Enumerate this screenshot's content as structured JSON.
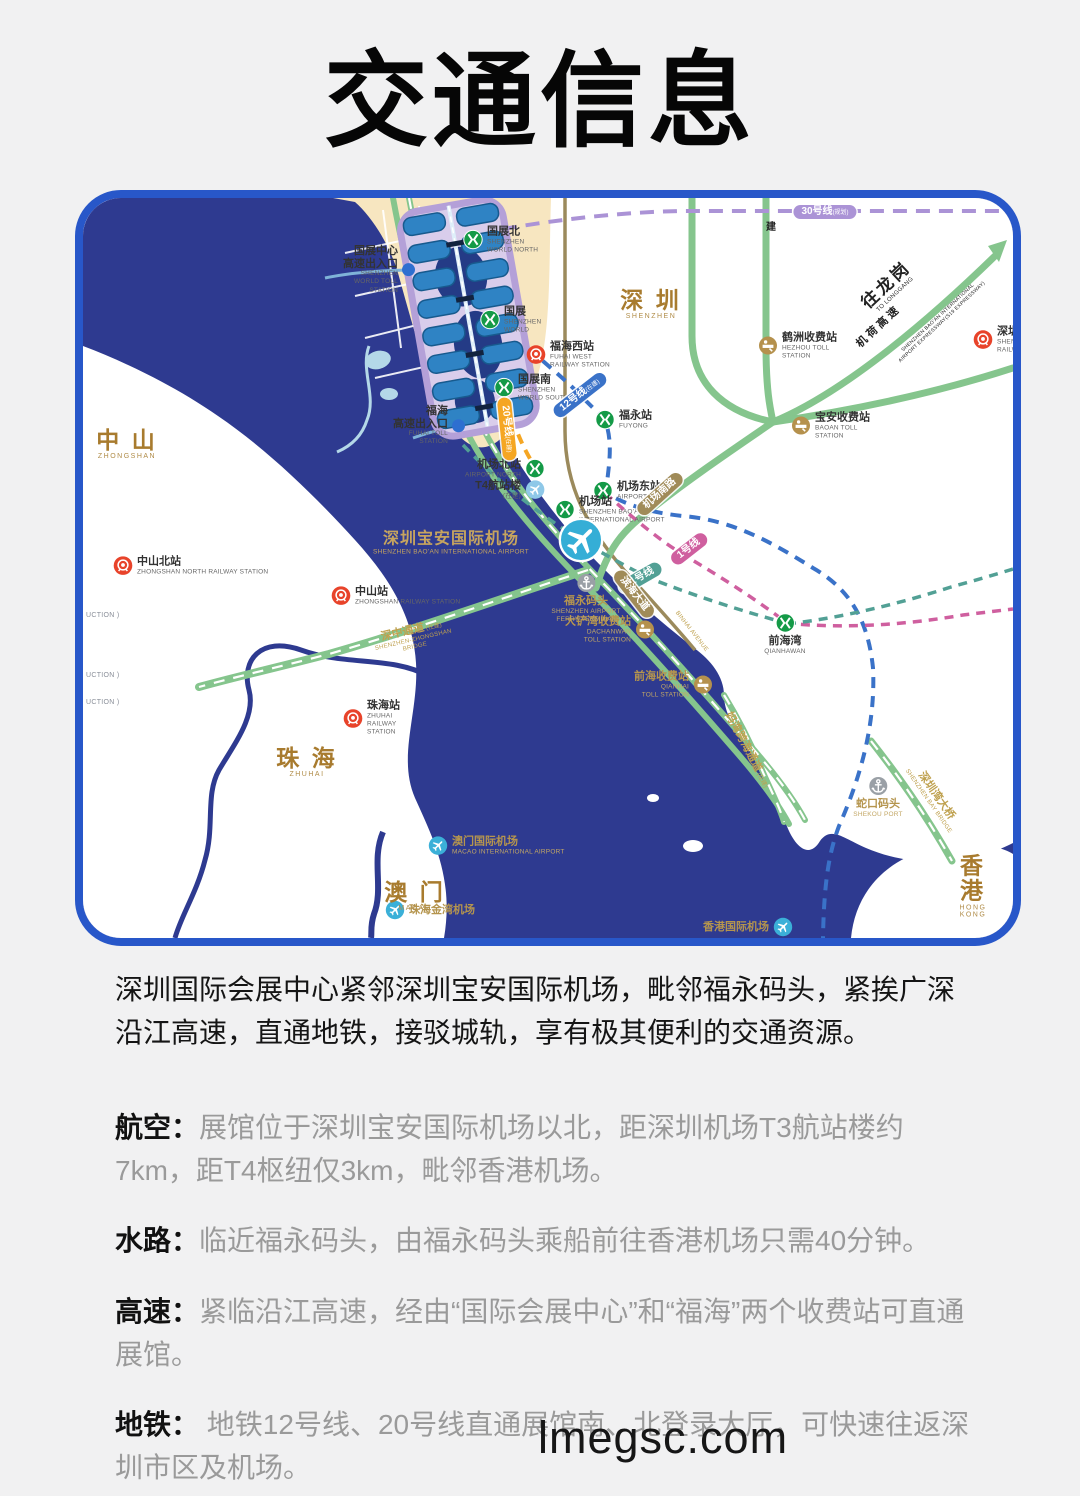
{
  "page": {
    "title": "交通信息",
    "watermark": "lmegsc.com",
    "background": "#f1f1f2"
  },
  "colors": {
    "map_border": "#2857c9",
    "sea": "#2e3a90",
    "land": "#ffffff",
    "district_land": "#f7e6c0",
    "road_green": "#85c58d",
    "road_khaki": "#9b8a5c",
    "line12_blue": "#3a72c8",
    "line20_orange": "#f5a623",
    "line30_purple": "#ab93d6",
    "line1_pink": "#cf5f9f",
    "line11_teal": "#52a095",
    "metro_green": "#149a47",
    "rail_red": "#e8432a",
    "toll_brown": "#b5914d",
    "plane_cyan": "#3bb0d8",
    "gold_text": "#bfa14f",
    "city_brown": "#a87b2e"
  },
  "map": {
    "regions": [
      {
        "name": "region-zhongshan",
        "zh": "中 山",
        "en": "ZHONGSHAN",
        "x": 44,
        "y": 246
      },
      {
        "name": "region-shenzhen",
        "zh": "深 圳",
        "en": "SHENZHEN",
        "x": 568,
        "y": 106
      },
      {
        "name": "region-zhuhai",
        "zh": "珠 海",
        "en": "ZHUHAI",
        "x": 224,
        "y": 564
      },
      {
        "name": "region-macao",
        "zh": "澳 门",
        "en": "MACAO",
        "x": 332,
        "y": 698
      },
      {
        "name": "region-hongkong",
        "zh": "香 港",
        "en": "HONG KONG",
        "x": 890,
        "y": 688
      }
    ],
    "sea_labels": [
      {
        "name": "label-baoan-airport",
        "zh": "深圳宝安国际机场",
        "en": "SHENZHEN BAO'AN INTERNATIONAL AIRPORT",
        "x": 368,
        "y": 342
      }
    ],
    "stations": [
      {
        "name": "station-shenzhen-world-north",
        "icon": "metro",
        "x": 390,
        "y": 42,
        "zh": "国展北",
        "en": "SHENZHEN\nWORLD NORTH",
        "align": "right"
      },
      {
        "name": "station-shenzhen-world",
        "icon": "metro",
        "x": 407,
        "y": 122,
        "zh": "国展",
        "en": "SHENZHEN\nWORLD",
        "align": "right"
      },
      {
        "name": "station-shenzhen-world-south",
        "icon": "metro",
        "x": 421,
        "y": 190,
        "zh": "国展南",
        "en": "SHENZHEN\nWORLD SOUTH",
        "align": "right"
      },
      {
        "name": "station-fuyong",
        "icon": "metro",
        "x": 522,
        "y": 222,
        "zh": "福永站",
        "en": "FUYONG",
        "align": "right"
      },
      {
        "name": "station-airport-north",
        "icon": "metro",
        "x": 452,
        "y": 271,
        "zh": "机场北站",
        "en": "AIRPORT NORTH",
        "align": "left"
      },
      {
        "name": "station-t4-terminal",
        "icon": "planeS",
        "c": "#8fc8e8",
        "x": 452,
        "y": 292,
        "zh": "T4航站楼",
        "en": "(在建)",
        "align": "left"
      },
      {
        "name": "station-airport-east",
        "icon": "metro",
        "x": 520,
        "y": 293,
        "zh": "机场东站",
        "en": "AIRPORT EAST",
        "align": "right"
      },
      {
        "name": "station-airport",
        "icon": "metro",
        "x": 482,
        "y": 312,
        "zh": "机场站",
        "en": "SHENZHEN BAO'AN\nINTERNATIONAL AIRPORT",
        "align": "right"
      },
      {
        "name": "airport-plane-marker",
        "icon": "planeB",
        "x": 485,
        "y": 342,
        "zh": "",
        "en": "",
        "align": "right"
      },
      {
        "name": "station-qianhaiwan",
        "icon": "metro",
        "x": 702,
        "y": 425,
        "zh": "前海湾",
        "en": "QIANHAWAN",
        "align": "below"
      },
      {
        "name": "station-fuhai-west",
        "icon": "rail",
        "x": 453,
        "y": 157,
        "zh": "福海西站",
        "en": "FUHAI WEST\nRAILWAY STATION",
        "align": "right"
      },
      {
        "name": "station-shenzhen-north",
        "icon": "rail",
        "x": 900,
        "y": 142,
        "zh": "深圳北站",
        "en": "SHENZHEN NORTH\nRAILWAY STATION",
        "align": "right"
      },
      {
        "name": "station-zhongshan-north",
        "icon": "rail",
        "x": 40,
        "y": 368,
        "zh": "中山北站",
        "en": "ZHONGSHAN NORTH RAILWAY STATION",
        "align": "right"
      },
      {
        "name": "station-zhongshan",
        "icon": "rail",
        "x": 258,
        "y": 398,
        "zh": "中山站",
        "en": "ZHONGSHAN RAILWAY STATION",
        "align": "right"
      },
      {
        "name": "station-zhuhai",
        "icon": "rail",
        "x": 270,
        "y": 520,
        "zh": "珠海站",
        "en": "ZHUHAI\nRAILWAY\nSTATION",
        "align": "right"
      },
      {
        "name": "toll-hezhou",
        "icon": "toll",
        "x": 685,
        "y": 148,
        "zh": "鹤洲收费站",
        "en": "HEZHOU TOLL\nSTATION",
        "align": "right"
      },
      {
        "name": "toll-baoan",
        "icon": "toll",
        "x": 718,
        "y": 228,
        "zh": "宝安收费站",
        "en": "BAOAN TOLL\nSTATION",
        "align": "right"
      },
      {
        "name": "toll-dachanwan",
        "icon": "toll",
        "x": 562,
        "y": 432,
        "zh": "大铲湾收费站",
        "en": "DACHANWAN\nTOLL STATION",
        "align": "left",
        "gold": true
      },
      {
        "name": "toll-qianhai",
        "icon": "toll",
        "x": 620,
        "y": 487,
        "zh": "前海收费站",
        "en": "QIANHAI\nTOLL STATION",
        "align": "left",
        "gold": true
      },
      {
        "name": "port-fuyong-ferry",
        "icon": "anchor",
        "x": 503,
        "y": 385,
        "zh": "福永码头",
        "en": "SHENZHEN AIRPORT\nFERRY TERMINAL",
        "align": "below",
        "gold": true
      },
      {
        "name": "port-shekou",
        "icon": "anchor",
        "x": 795,
        "y": 588,
        "zh": "蛇口码头",
        "en": "SHEKOU PORT",
        "align": "below",
        "gold": true
      },
      {
        "name": "airport-macao",
        "icon": "planeS",
        "x": 355,
        "y": 648,
        "zh": "澳门国际机场",
        "en": "MACAO INTERNATIONAL AIRPORT",
        "align": "right",
        "gold": true
      },
      {
        "name": "airport-zhuhai-jinwan",
        "icon": "planeS",
        "x": 312,
        "y": 712,
        "zh": "珠海金湾机场",
        "en": "",
        "align": "right",
        "gold": true
      },
      {
        "name": "airport-hongkong",
        "icon": "planeS",
        "x": 700,
        "y": 729,
        "zh": "香港国际机场",
        "en": "",
        "align": "left",
        "gold": true
      },
      {
        "name": "entrance-shenzhen-world-toll",
        "icon": "dot",
        "x": 322,
        "y": 72,
        "zh": "国展中心\n高速出入口",
        "en": "SHENZHEN\nWORLD TOLL\nSTATION",
        "align": "left"
      },
      {
        "name": "entrance-fuhai-toll",
        "icon": "dot",
        "x": 372,
        "y": 228,
        "zh": "福海\n高速出入口",
        "en": "FUHAI TOLL\nSTATION",
        "align": "left"
      }
    ],
    "line_pills": [
      {
        "name": "pill-line-30",
        "label": "30号线",
        "sfx": "(规划)",
        "x": 742,
        "y": 14,
        "rot": 0,
        "bg": "#ab93d6"
      },
      {
        "name": "pill-line-12",
        "label": "12号线",
        "sfx": "(在建)",
        "x": 497,
        "y": 197,
        "rot": -38,
        "bg": "#3a72c8"
      },
      {
        "name": "pill-line-20",
        "label": "20号线",
        "sfx": "(在建)",
        "x": 424,
        "y": 231,
        "rot": 84,
        "bg": "#f5a623"
      },
      {
        "name": "pill-line-1",
        "label": "1号线",
        "sfx": "",
        "x": 606,
        "y": 351,
        "rot": -38,
        "bg": "#cf5f9f"
      },
      {
        "name": "pill-line-11",
        "label": "11号线",
        "sfx": "",
        "x": 557,
        "y": 380,
        "rot": -30,
        "bg": "#52a095"
      },
      {
        "name": "pill-binhai-avenue",
        "label": "滨海大道",
        "sfx": "",
        "x": 551,
        "y": 396,
        "rot": 52,
        "bg": "#a08b58"
      },
      {
        "name": "pill-airport-south-road",
        "label": "机场南路",
        "sfx": "",
        "x": 577,
        "y": 296,
        "rot": -42,
        "bg": "#a08b58"
      }
    ],
    "road_labels": [
      {
        "name": "label-shenzhong-bridge",
        "zh": "深中通道",
        "sfx": "(在建)",
        "en": "SHENZHEN-ZHONGSHAN\nBRIDGE",
        "x": 330,
        "y": 440,
        "rot": -13,
        "cls": "gold"
      },
      {
        "name": "label-mawan-crossing",
        "zh": "妈湾跨海通道",
        "sfx": "(在建)",
        "en": "",
        "x": 664,
        "y": 552,
        "rot": 62,
        "cls": "gold"
      },
      {
        "name": "label-shenzhen-bay-bridge",
        "zh": "深圳湾大桥",
        "sfx": "",
        "en": "SHENZHEN BAY BRIDGE",
        "x": 850,
        "y": 600,
        "rot": 55,
        "cls": "gold"
      },
      {
        "name": "label-binhai-avenue-en",
        "zh": "",
        "sfx": "",
        "en": "BINHAI AVENUE",
        "x": 608,
        "y": 434,
        "rot": 52,
        "cls": "gold"
      },
      {
        "name": "label-jihe-expressway",
        "zh": "机 荷 高 速",
        "sfx": "",
        "en": "",
        "x": 795,
        "y": 130,
        "rot": -43,
        "cls": "dark"
      },
      {
        "name": "label-to-longgang",
        "zh": "往龙岗",
        "sfx": "",
        "en": "TO LONGGANG",
        "x": 806,
        "y": 90,
        "rot": -43,
        "cls": "dark lg"
      },
      {
        "name": "label-s19-expressway",
        "zh": "",
        "sfx": "",
        "en": "SHENZHEN BAO'AN INTERNATIONAL\nAIRPORT EXPRESSWAY(S19 EXPRESSWAY)",
        "x": 857,
        "y": 122,
        "rot": -43,
        "cls": "dark tiny"
      },
      {
        "name": "label-jian",
        "zh": "建",
        "sfx": "",
        "en": "",
        "x": 688,
        "y": 30,
        "rot": 0,
        "cls": "dark sm"
      },
      {
        "name": "label-cut-1",
        "zh": "",
        "sfx": "",
        "en": "UCTION )",
        "x": 3,
        "y": 418,
        "rot": 0,
        "cls": "gray edge"
      },
      {
        "name": "label-cut-2",
        "zh": "",
        "sfx": "",
        "en": "UCTION )",
        "x": 3,
        "y": 478,
        "rot": 0,
        "cls": "gray edge"
      },
      {
        "name": "label-cut-3",
        "zh": "",
        "sfx": "",
        "en": "UCTION )",
        "x": 3,
        "y": 505,
        "rot": 0,
        "cls": "gray edge"
      }
    ]
  },
  "sections": {
    "intro": "深圳国际会展中心紧邻深圳宝安国际机场，毗邻福永码头，紧挨广深沿江高速，直通地铁，接驳城轨，享有极其便利的交通资源。",
    "items": [
      {
        "label": "航空：",
        "text": "展馆位于深圳宝安国际机场以北，距深圳机场T3航站楼约7km，距T4枢纽仅3km，毗邻香港机场。"
      },
      {
        "label": "水路：",
        "text": "临近福永码头，由福永码头乘船前往香港机场只需40分钟。"
      },
      {
        "label": "高速：",
        "text": "紧临沿江高速，经由“国际会展中心”和“福海”两个收费站可直通展馆。"
      },
      {
        "label": "地铁：",
        "text": " 地铁12号线、20号线直通展馆南、北登录大厅，可快速往返深圳市区及机场。"
      }
    ]
  }
}
